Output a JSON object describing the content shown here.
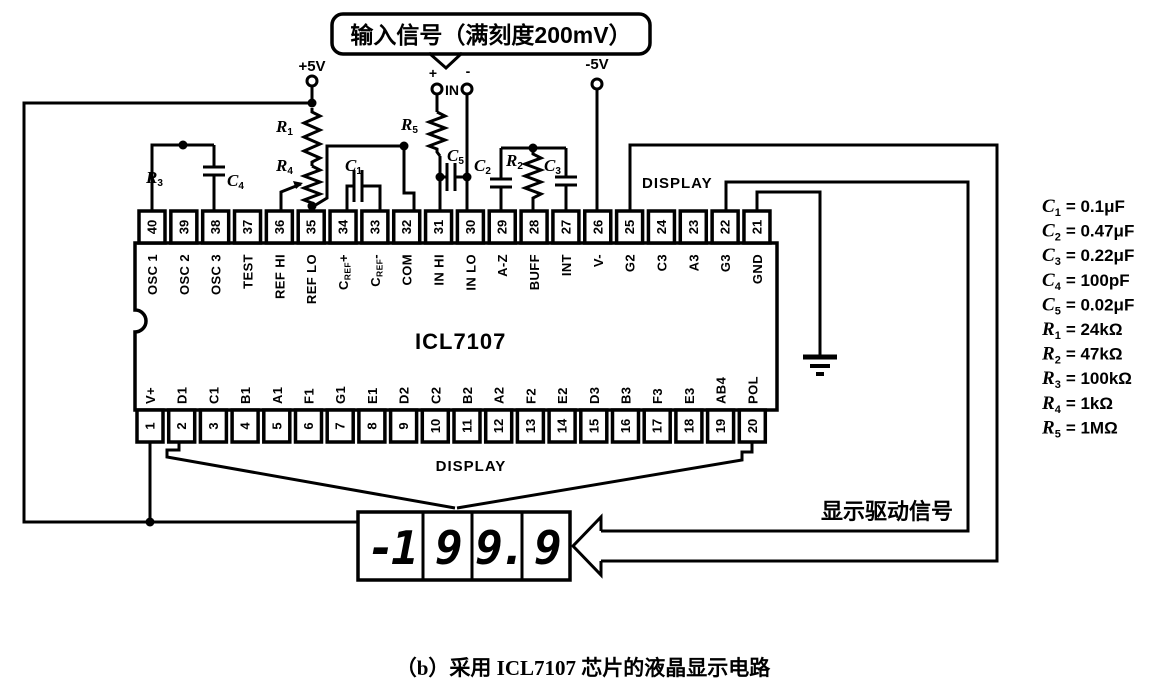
{
  "callout": {
    "text": "输入信号（满刻度200mV）"
  },
  "terminals": {
    "plus5v": "+5V",
    "minus5v": "-5V",
    "in_label": "IN",
    "in_plus": "+",
    "in_minus": "-"
  },
  "ic": {
    "name": "ICL7107"
  },
  "pins": {
    "top": [
      {
        "num": "40",
        "label": "OSC 1"
      },
      {
        "num": "39",
        "label": "OSC 2"
      },
      {
        "num": "38",
        "label": "OSC 3"
      },
      {
        "num": "37",
        "label": "TEST"
      },
      {
        "num": "36",
        "label": "REF HI"
      },
      {
        "num": "35",
        "label": "REF LO"
      },
      {
        "num": "34",
        "label": "CREF+"
      },
      {
        "num": "33",
        "label": "CREF-"
      },
      {
        "num": "32",
        "label": "COM"
      },
      {
        "num": "31",
        "label": "IN HI"
      },
      {
        "num": "30",
        "label": "IN LO"
      },
      {
        "num": "29",
        "label": "A-Z"
      },
      {
        "num": "28",
        "label": "BUFF"
      },
      {
        "num": "27",
        "label": "INT"
      },
      {
        "num": "26",
        "label": "V-"
      },
      {
        "num": "25",
        "label": "G2"
      },
      {
        "num": "24",
        "label": "C3"
      },
      {
        "num": "23",
        "label": "A3"
      },
      {
        "num": "22",
        "label": "G3"
      },
      {
        "num": "21",
        "label": "GND"
      }
    ],
    "bottom": [
      {
        "num": "1",
        "label": "V+"
      },
      {
        "num": "2",
        "label": "D1"
      },
      {
        "num": "3",
        "label": "C1"
      },
      {
        "num": "4",
        "label": "B1"
      },
      {
        "num": "5",
        "label": "A1"
      },
      {
        "num": "6",
        "label": "F1"
      },
      {
        "num": "7",
        "label": "G1"
      },
      {
        "num": "8",
        "label": "E1"
      },
      {
        "num": "9",
        "label": "D2"
      },
      {
        "num": "10",
        "label": "C2"
      },
      {
        "num": "11",
        "label": "B2"
      },
      {
        "num": "12",
        "label": "A2"
      },
      {
        "num": "13",
        "label": "F2"
      },
      {
        "num": "14",
        "label": "E2"
      },
      {
        "num": "15",
        "label": "D3"
      },
      {
        "num": "16",
        "label": "B3"
      },
      {
        "num": "17",
        "label": "F3"
      },
      {
        "num": "18",
        "label": "E3"
      },
      {
        "num": "19",
        "label": "AB4"
      },
      {
        "num": "20",
        "label": "POL"
      }
    ]
  },
  "component_refs": [
    {
      "sym": "R",
      "sub": "3"
    },
    {
      "sym": "C",
      "sub": "4"
    },
    {
      "sym": "R",
      "sub": "1"
    },
    {
      "sym": "R",
      "sub": "4"
    },
    {
      "sym": "C",
      "sub": "1"
    },
    {
      "sym": "R",
      "sub": "5"
    },
    {
      "sym": "C",
      "sub": "5"
    },
    {
      "sym": "C",
      "sub": "2"
    },
    {
      "sym": "R",
      "sub": "2"
    },
    {
      "sym": "C",
      "sub": "3"
    }
  ],
  "display": {
    "top_label": "DISPLAY",
    "bottom_label": "DISPLAY",
    "digits": [
      "-1",
      "9",
      "9.",
      "9"
    ],
    "drive_label": "显示驱动信号"
  },
  "values": [
    {
      "sym": "C",
      "sub": "1",
      "rhs": "= 0.1μF"
    },
    {
      "sym": "C",
      "sub": "2",
      "rhs": "= 0.47μF"
    },
    {
      "sym": "C",
      "sub": "3",
      "rhs": "= 0.22μF"
    },
    {
      "sym": "C",
      "sub": "4",
      "rhs": "= 100pF"
    },
    {
      "sym": "C",
      "sub": "5",
      "rhs": "= 0.02μF"
    },
    {
      "sym": "R",
      "sub": "1",
      "rhs": "= 24kΩ"
    },
    {
      "sym": "R",
      "sub": "2",
      "rhs": "= 47kΩ"
    },
    {
      "sym": "R",
      "sub": "3",
      "rhs": "= 100kΩ"
    },
    {
      "sym": "R",
      "sub": "4",
      "rhs": "= 1kΩ"
    },
    {
      "sym": "R",
      "sub": "5",
      "rhs": "= 1MΩ"
    }
  ],
  "caption": "（b）采用 ICL7107 芯片的液晶显示电路"
}
